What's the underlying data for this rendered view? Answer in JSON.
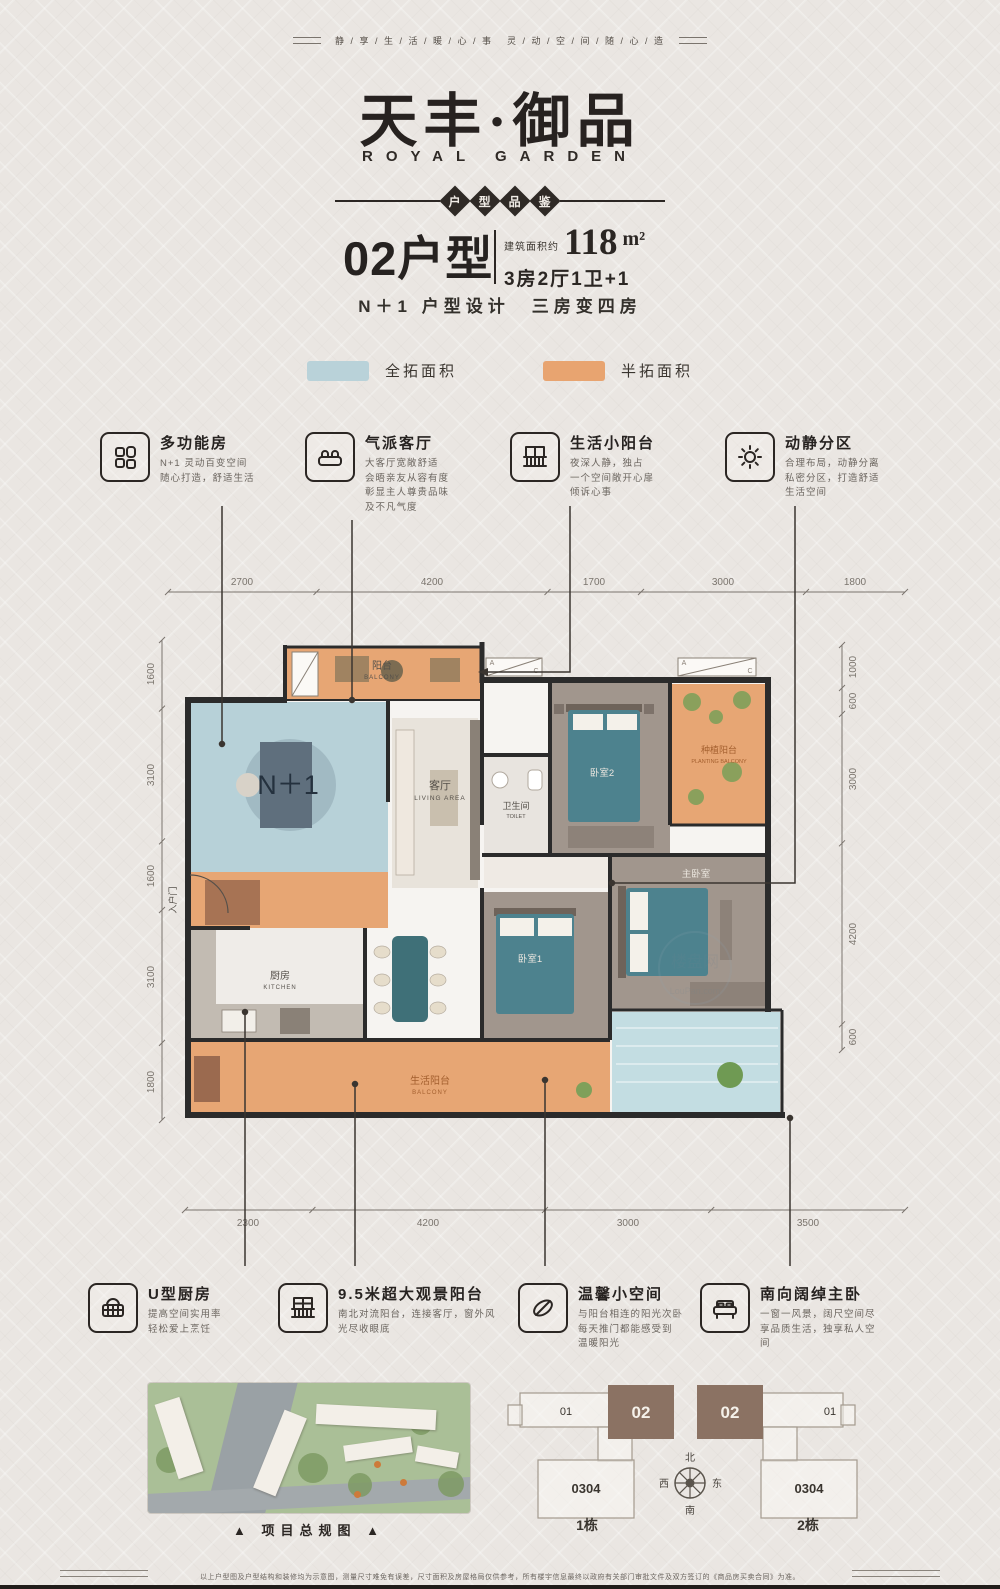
{
  "header": {
    "slogan_left": "静 / 享 / 生 / 活 / 暖 / 心 / 事",
    "slogan_right": "灵 / 动 / 空 / 间 / 随 / 心 / 造",
    "title_cn": "天丰·御品",
    "title_en": "ROYAL GARDEN",
    "badge_chars": [
      "户",
      "型",
      "品",
      "鉴"
    ]
  },
  "unit": {
    "code": "02户型",
    "area_prefix": "建筑面积约",
    "area": "118",
    "area_unit": "m²",
    "rooms": "3房2厅1卫+1",
    "design": "N＋1 户型设计　三房变四房"
  },
  "legend": {
    "full": {
      "label": "全拓面积",
      "color": "#b9d2d9"
    },
    "half": {
      "label": "半拓面积",
      "color": "#e8a470"
    }
  },
  "features_top": [
    {
      "icon": "grid-icon",
      "title": "多功能房",
      "desc": "N+1 灵动百变空间\n随心打造，舒适生活"
    },
    {
      "icon": "sofa-icon",
      "title": "气派客厅",
      "desc": "大客厅宽敞舒适\n会晤亲友从容有度\n彰显主人尊贵品味\n及不凡气度"
    },
    {
      "icon": "railing-icon",
      "title": "生活小阳台",
      "desc": "夜深人静，独占\n一个空间敞开心扉\n倾诉心事"
    },
    {
      "icon": "sun-icon",
      "title": "动静分区",
      "desc": "合理布局，动静分离\n私密分区，打造舒适\n生活空间"
    }
  ],
  "features_bottom": [
    {
      "icon": "basket-icon",
      "title": "U型厨房",
      "desc": "提高空间实用率\n轻松爱上烹饪"
    },
    {
      "icon": "window-icon",
      "title": "9.5米超大观景阳台",
      "desc": "南北对流阳台，连接客厅，窗外风\n光尽收眼底"
    },
    {
      "icon": "leaf-icon",
      "title": "温馨小空间",
      "desc": "与阳台相连的阳光次卧\n每天推门都能感受到\n温暖阳光"
    },
    {
      "icon": "bed-icon",
      "title": "南向阔绰主卧",
      "desc": "一窗一风景，阔尺空间尽\n享品质生活，独享私人空\n间"
    }
  ],
  "plan": {
    "labels": {
      "balcony": "阳台",
      "balcony_en": "BALCONY",
      "nplus": "N＋1",
      "entry": "入户门",
      "living": "客厅",
      "living_en": "LIVING AREA",
      "kitchen": "厨房",
      "kitchen_en": "KITCHEN",
      "bath": "卫生间",
      "bath_en": "TOILET",
      "bed2": "卧室2",
      "planting": "种植阳台",
      "planting_en": "PLANTING BALCONY",
      "bed1": "卧室1",
      "master": "主卧室",
      "life_balcony": "生活阳台",
      "life_balcony_en": "BALCONY",
      "ac_a": "A",
      "ac_c": "C"
    },
    "dims": {
      "top": [
        "2700",
        "4200",
        "1700",
        "3000",
        "1800"
      ],
      "bottom": [
        "2300",
        "4200",
        "3000",
        "3500"
      ],
      "left": [
        "1600",
        "3100",
        "1600",
        "3100",
        "1800"
      ],
      "right": [
        "1000",
        "600",
        "3000",
        "4200",
        "600"
      ]
    },
    "watermark": {
      "cn": "楼盘网",
      "en": "LouPan.com"
    }
  },
  "footprint": {
    "building1": "1栋",
    "building2": "2栋",
    "unit01": "01",
    "unit02": "02",
    "unit0304": "0304",
    "compass": {
      "north": "北",
      "south": "南",
      "west": "西",
      "east": "东"
    },
    "site_caption": "▲ 项目总规图 ▲"
  },
  "footer": {
    "disclaimer": "以上户型图及户型结构和装修均为示意图，测量尺寸难免有误差，尺寸面积及房屋格局仅供参考，所有楼宇信息最终以政府有关部门审批文件及双方签订的《商品房买卖合同》为准。"
  }
}
